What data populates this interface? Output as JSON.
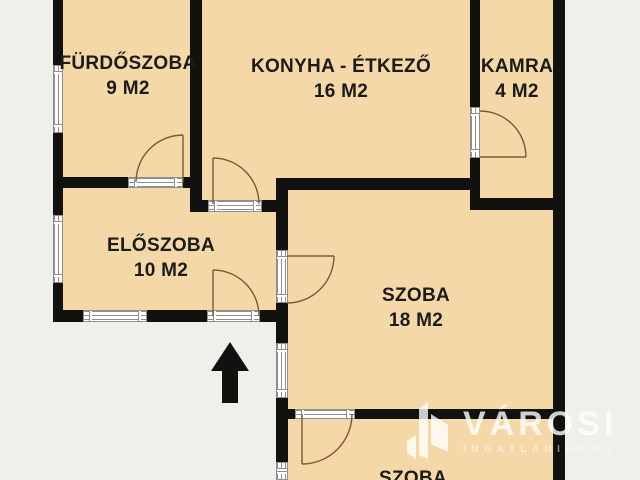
{
  "plan": {
    "colors": {
      "floor": "#f4d8a7",
      "wall": "#111110",
      "outside": "#f1efe9",
      "door": "#7d5a33",
      "label": "#1b1b1a"
    },
    "rooms": [
      {
        "id": "furdoszoba",
        "name": "FÜRDŐSZOBA",
        "area": "9 M2"
      },
      {
        "id": "konyha-etkezo",
        "name": "KONYHA - ÉTKEZŐ",
        "area": "16 M2"
      },
      {
        "id": "kamra",
        "name": "KAMRA",
        "area": "4 M2"
      },
      {
        "id": "eloszoba",
        "name": "ELŐSZOBA",
        "area": "10 M2"
      },
      {
        "id": "szoba-18",
        "name": "SZOBA",
        "area": "18 M2"
      },
      {
        "id": "szoba-also",
        "name": "SZOBA"
      }
    ],
    "icons": {
      "entrance_arrow": "up-arrow marking the entrance",
      "window": "triple-line glazing symbol",
      "door_swing": "quarter-circle door swing"
    },
    "watermark": {
      "brand": "VÁROSI",
      "subtitle": "INGATLANIRODA"
    }
  }
}
